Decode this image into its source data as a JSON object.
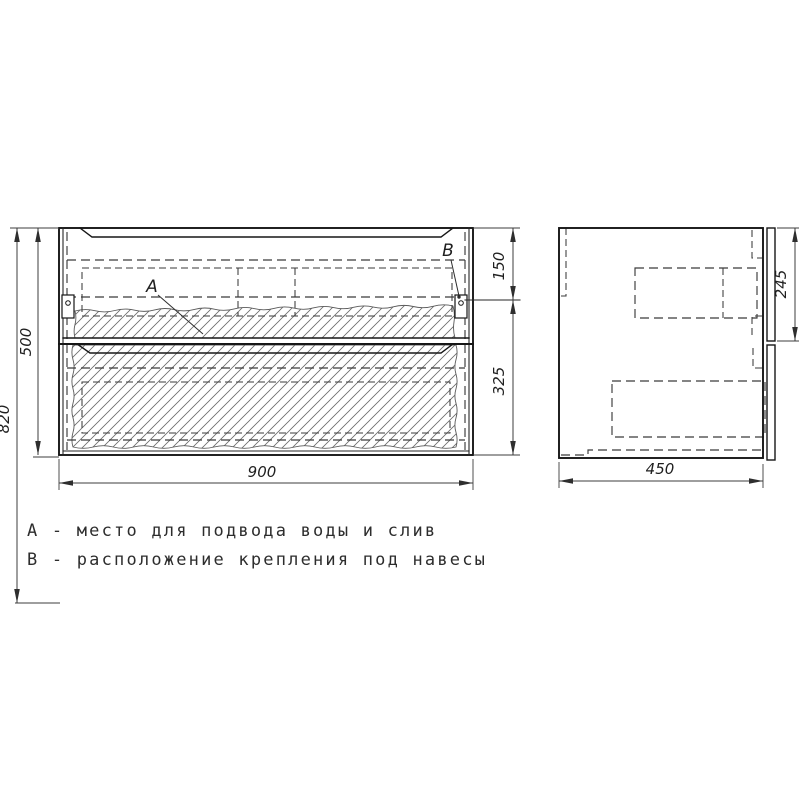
{
  "drawing": {
    "ink_color": "#1a1a1a",
    "background_color": "#ffffff",
    "dimensions": {
      "front": {
        "overall_height": "820",
        "cabinet_height": "500",
        "width": "900",
        "top_to_mount": "150",
        "mount_to_bottom": "325"
      },
      "side": {
        "depth": "450",
        "drawer_front_height": "245"
      }
    },
    "markers": {
      "a": "A",
      "b": "B"
    },
    "legend": {
      "line_a": "А - место для подвода воды и слив",
      "line_b": "В - расположение крепления под навесы"
    }
  }
}
